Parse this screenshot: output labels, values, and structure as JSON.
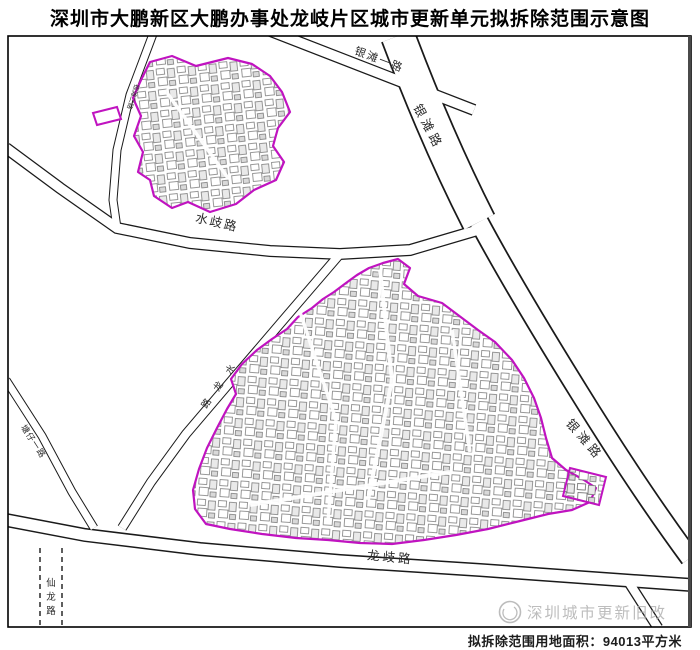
{
  "title": "深圳市大鹏新区大鹏办事处龙岐片区城市更新单元拟拆除范围示意图",
  "map": {
    "boundary_color": "#C013C0",
    "road_color": "#1a1a1a",
    "areas": [
      {
        "name": "north-demolition-area"
      },
      {
        "name": "north-detached-parcel"
      },
      {
        "name": "south-demolition-area"
      },
      {
        "name": "south-detached-parcel"
      }
    ],
    "road_labels": [
      {
        "id": "yintan-yilu",
        "text": "银滩一路"
      },
      {
        "id": "yintan-top",
        "text": "银滩路"
      },
      {
        "id": "yintan-right",
        "text": "银滩路"
      },
      {
        "id": "small-road",
        "text": "银滩二路"
      },
      {
        "id": "shuiqi",
        "text": "水歧路"
      },
      {
        "id": "shuilong",
        "text": "水龙路"
      },
      {
        "id": "tangzai",
        "text": "塘仔一路"
      },
      {
        "id": "xianlong",
        "text": "仙龙路"
      },
      {
        "id": "longqi",
        "text": "龙歧路"
      }
    ]
  },
  "watermark": {
    "logo": "circle-swirl-logo",
    "text": "深圳城市更新旧改",
    "color": "#afafaf"
  },
  "footer": {
    "area_label": "拟拆除范围用地面积：94013平方米"
  }
}
